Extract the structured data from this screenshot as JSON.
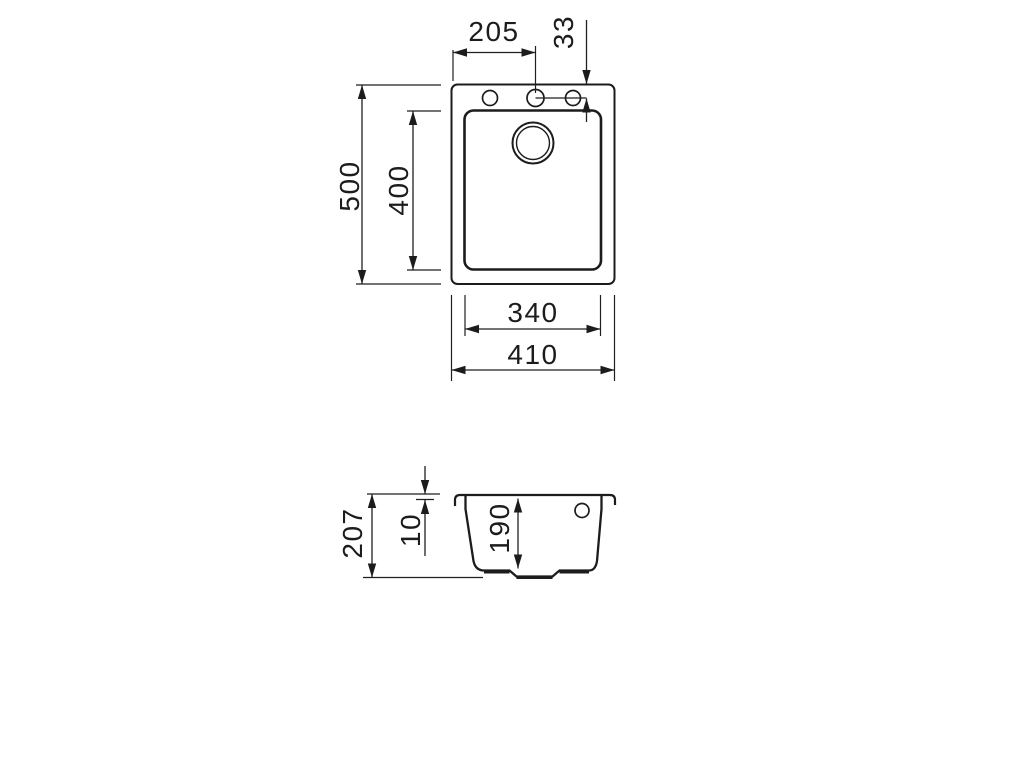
{
  "top_view": {
    "overall_width": "410",
    "bowl_width": "340",
    "overall_depth": "500",
    "bowl_depth": "400",
    "tap_hole_offset_x": "205",
    "tap_hole_offset_y": "33"
  },
  "section_view": {
    "overall_height": "207",
    "rim_thickness": "10",
    "bowl_depth": "190"
  },
  "colors": {
    "line": "#1c1c1c",
    "background": "#ffffff"
  }
}
